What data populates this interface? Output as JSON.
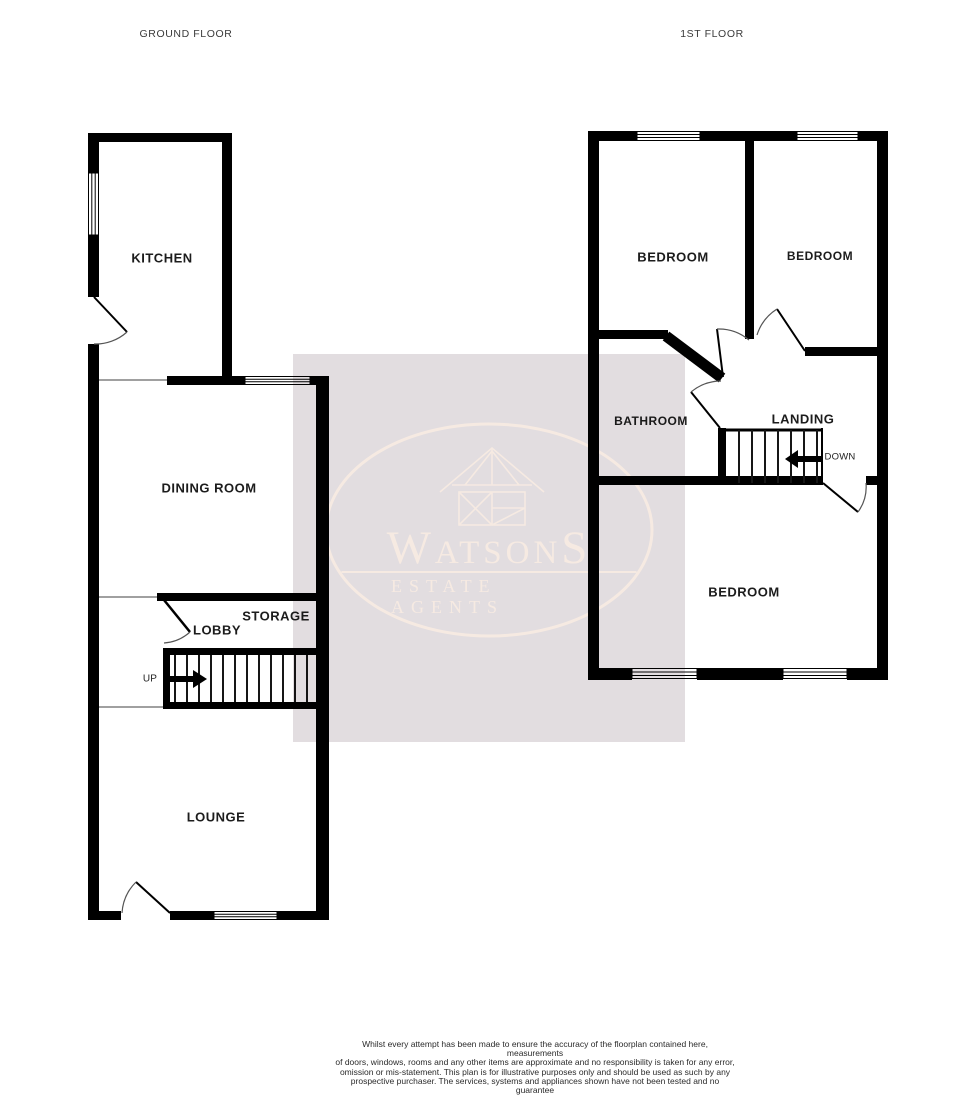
{
  "titles": {
    "ground_floor": "GROUND FLOOR",
    "first_floor": "1ST FLOOR"
  },
  "ground_floor": {
    "kitchen": "KITCHEN",
    "dining_room": "DINING ROOM",
    "storage": "STORAGE",
    "lobby": "LOBBY",
    "lounge": "LOUNGE",
    "stairs_direction": "UP"
  },
  "first_floor": {
    "bedroom_top_left": "BEDROOM",
    "bedroom_top_right": "BEDROOM",
    "bathroom": "BATHROOM",
    "landing": "LANDING",
    "bedroom_bottom": "BEDROOM",
    "stairs_direction": "DOWN"
  },
  "watermark": {
    "brand": "WatsonS",
    "tagline": "ESTATE AGENTS",
    "icon": "house-logo-icon",
    "box_color": "#e2dde0",
    "logo_color": "#f6eae2"
  },
  "footer": {
    "disclaimer_lines": [
      "Whilst every attempt has been made to ensure the accuracy of the floorplan contained here, measurements",
      "of doors, windows, rooms and any other items are approximate and no responsibility is taken for any error,",
      "omission or mis-statement. This plan is for illustrative purposes only and should be used as such by any",
      "prospective purchaser. The services, systems and appliances shown have not been tested and no guarantee",
      "as to their operability or efficiency can be given."
    ],
    "made_with": "Made with Metropix ©2026"
  },
  "colors": {
    "wall": "#000000",
    "divider_line": "#808080",
    "door_arc": "#555555",
    "step_line": "#161616",
    "label_text": "#1c1c1c"
  }
}
